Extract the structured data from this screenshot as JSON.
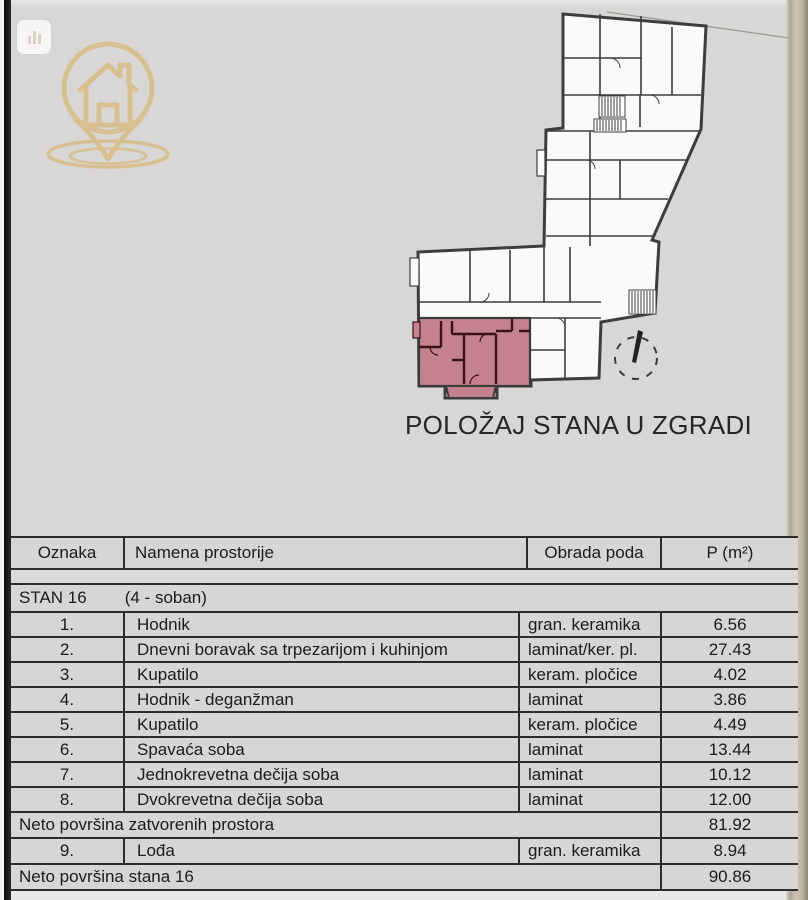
{
  "page": {
    "caption": "POLOŽAJ STANA U ZGRADI",
    "background_color": "#d8d7d5"
  },
  "logo": {
    "description": "location pin with house and ground rings",
    "color": "#d8be8c"
  },
  "plan": {
    "description": "building floor plan with highlighted apartment and north arrow",
    "highlight_color": "#c4828e",
    "apartment_wall_color": "#3a1019",
    "wall_color": "#3d3d3d"
  },
  "table": {
    "headers": [
      "Oznaka",
      "Namena prostorije",
      "Obrada poda",
      "P (m²)"
    ],
    "group": {
      "name": "STAN 16",
      "type": "(4 - soban)"
    },
    "rows": [
      {
        "num": "1.",
        "name": "Hodnik",
        "floor": "gran. keramika",
        "area": "6.56"
      },
      {
        "num": "2.",
        "name": "Dnevni boravak sa trpezarijom i kuhinjom",
        "floor": "laminat/ker. pl.",
        "area": "27.43"
      },
      {
        "num": "3.",
        "name": "Kupatilo",
        "floor": "keram. pločice",
        "area": "4.02"
      },
      {
        "num": "4.",
        "name": "Hodnik - deganžman",
        "floor": "laminat",
        "area": "3.86"
      },
      {
        "num": "5.",
        "name": "Kupatilo",
        "floor": "keram. pločice",
        "area": "4.49"
      },
      {
        "num": "6.",
        "name": "Spavaća soba",
        "floor": "laminat",
        "area": "13.44"
      },
      {
        "num": "7.",
        "name": "Jednokrevetna dečija soba",
        "floor": "laminat",
        "area": "10.12"
      },
      {
        "num": "8.",
        "name": "Dvokrevetna dečija soba",
        "floor": "laminat",
        "area": "12.00"
      }
    ],
    "subtotal": {
      "label": "Neto površina zatvorenih prostora",
      "area": "81.92"
    },
    "loggia_row": {
      "num": "9.",
      "name": "Lođa",
      "floor": "gran. keramika",
      "area": "8.94"
    },
    "total": {
      "label": "Neto površina stana 16",
      "area": "90.86"
    }
  }
}
